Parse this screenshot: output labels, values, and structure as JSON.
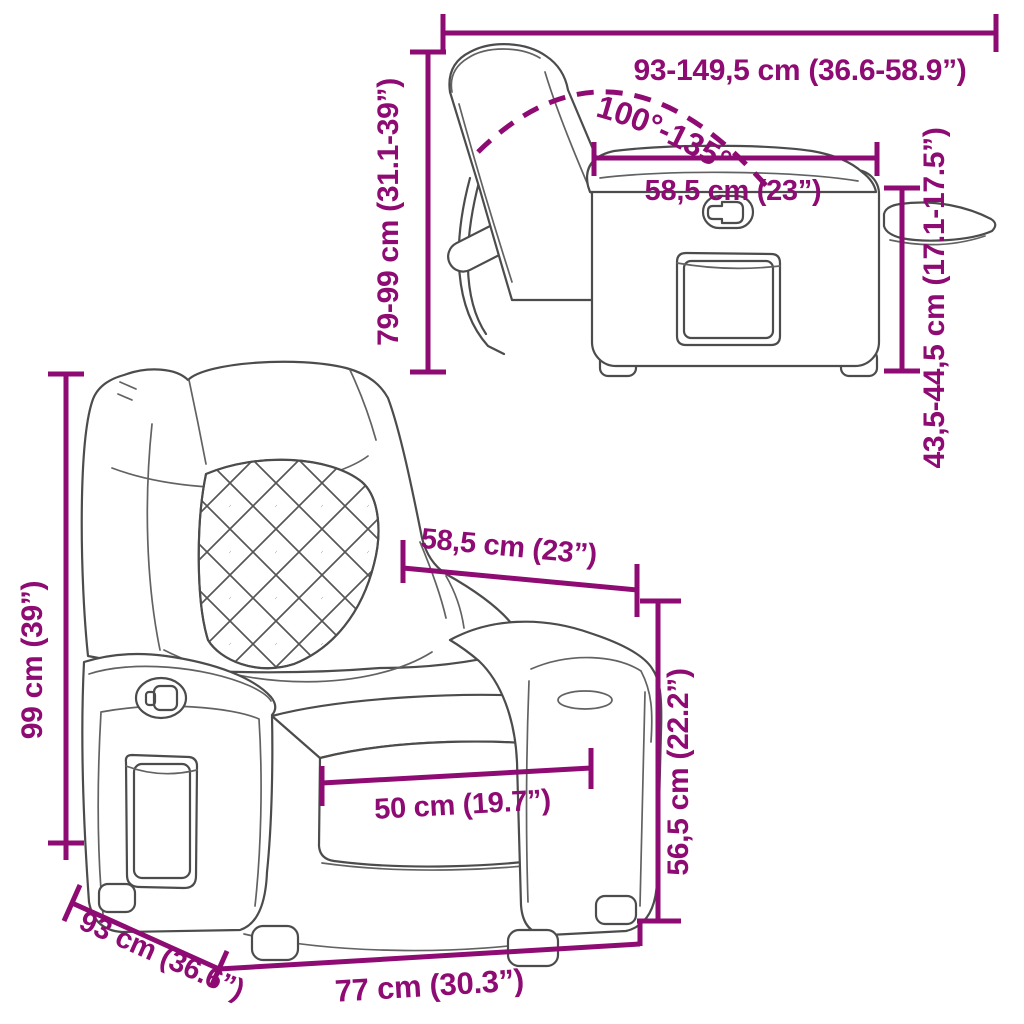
{
  "colors": {
    "dimension_accent": "#8d0b72",
    "line_art": "#4c4c4c",
    "background": "#ffffff"
  },
  "dims": {
    "recline_length": "93-149,5 cm (36.6-58.9”)",
    "recline_angle": "100°-135°",
    "side_height": "79-99 cm (31.1-39”)",
    "side_seat_depth": "58,5 cm (23”)",
    "side_arm_height": "43,5-44,5 cm (17.1-17.5”)",
    "front_height": "99 cm (39”)",
    "front_top_width": "58,5 cm (23”)",
    "front_seat_width": "50 cm (19.7”)",
    "front_seat_height": "56,5 cm (22.2”)",
    "front_depth": "93 cm (36.6”)",
    "front_width": "77 cm (30.3”)"
  }
}
